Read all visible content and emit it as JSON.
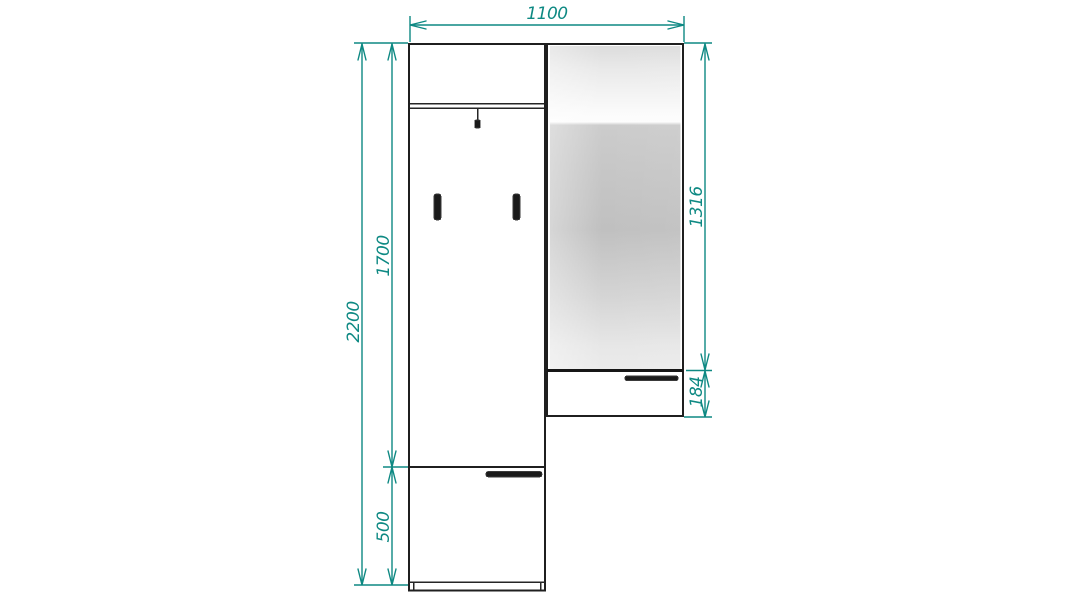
{
  "drawing": {
    "colors": {
      "dimension_accent": "#0E8983",
      "outline": "#1f1f1f",
      "hardware": "#1a1a1a",
      "mirror_gray": "#c6c6c6",
      "background": "#ffffff"
    },
    "dimensions": {
      "total_width": "1100",
      "total_height": "2200",
      "upper_section_height": "1700",
      "lower_cabinet_height": "500",
      "mirror_panel_height": "1316",
      "drawer_height": "184"
    }
  }
}
